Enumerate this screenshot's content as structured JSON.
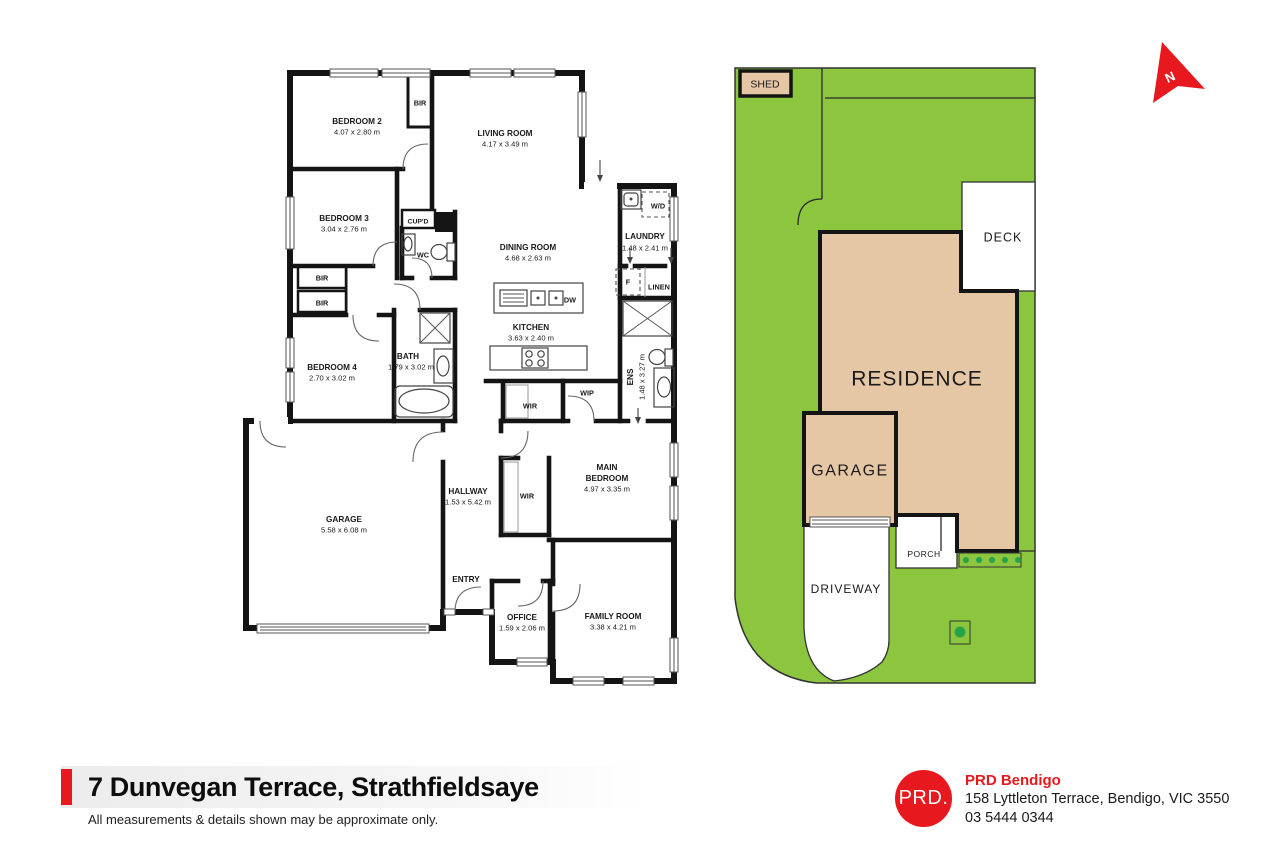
{
  "document_title": "Floor plan flyer",
  "footer": {
    "title": "7 Dunvegan Terrace, Strathfieldsaye",
    "disclaimer": "All measurements & details shown may be approximate only.",
    "brand": {
      "logo": "PRD.",
      "name": "PRD Bendigo",
      "address": "158 Lyttleton Terrace, Bendigo, VIC 3550",
      "phone": "03 5444 0344"
    }
  },
  "colors": {
    "accent_red": "#E8191E",
    "lot_green": "#8CC63F",
    "building_tan": "#E5C6A5",
    "wall_black": "#141414",
    "dot_green": "#29A347",
    "ink": "#1a1a1a"
  },
  "north_indicator": {
    "label": "N"
  },
  "plan_labels": [
    {
      "t": "BEDROOM 2",
      "x": 357,
      "y": 121,
      "s": 8.2,
      "b": 1
    },
    {
      "t": "4.07 x 2.80 m",
      "x": 357,
      "y": 132,
      "s": 7.6
    },
    {
      "t": "BIR",
      "x": 420,
      "y": 103,
      "s": 7.3,
      "b": 1
    },
    {
      "t": "LIVING ROOM",
      "x": 505,
      "y": 133,
      "s": 8.2,
      "b": 1
    },
    {
      "t": "4.17 x 3.49 m",
      "x": 505,
      "y": 144,
      "s": 7.6
    },
    {
      "t": "BEDROOM 3",
      "x": 344,
      "y": 218,
      "s": 8.2,
      "b": 1
    },
    {
      "t": "3.04 x 2.76 m",
      "x": 344,
      "y": 229,
      "s": 7.6
    },
    {
      "t": "CUP'D",
      "x": 418,
      "y": 221,
      "s": 6.8,
      "b": 1
    },
    {
      "t": "WC",
      "x": 423,
      "y": 255,
      "s": 7.3,
      "b": 1
    },
    {
      "t": "DINING ROOM",
      "x": 528,
      "y": 247,
      "s": 8.2,
      "b": 1
    },
    {
      "t": "4.68 x 2.63 m",
      "x": 528,
      "y": 258,
      "s": 7.6
    },
    {
      "t": "W/D",
      "x": 658,
      "y": 206,
      "s": 7.3,
      "b": 1
    },
    {
      "t": "LAUNDRY",
      "x": 645,
      "y": 236,
      "s": 8.2,
      "b": 1
    },
    {
      "t": "1.48 x 2.41 m",
      "x": 645,
      "y": 248,
      "s": 7.6
    },
    {
      "t": "F",
      "x": 628,
      "y": 282,
      "s": 7.3,
      "b": 1
    },
    {
      "t": "LINEN",
      "x": 659,
      "y": 287,
      "s": 7.3,
      "b": 1
    },
    {
      "t": "BIR",
      "x": 322,
      "y": 278,
      "s": 7.3,
      "b": 1
    },
    {
      "t": "BIR",
      "x": 322,
      "y": 303,
      "s": 7.3,
      "b": 1
    },
    {
      "t": "DW",
      "x": 570,
      "y": 300,
      "s": 7.3,
      "b": 1
    },
    {
      "t": "KITCHEN",
      "x": 531,
      "y": 327,
      "s": 8.2,
      "b": 1
    },
    {
      "t": "3.63 x 2.40 m",
      "x": 531,
      "y": 338,
      "s": 7.6
    },
    {
      "t": "BEDROOM 4",
      "x": 332,
      "y": 367,
      "s": 8.2,
      "b": 1
    },
    {
      "t": "2.70 x 3.02 m",
      "x": 332,
      "y": 378,
      "s": 7.6
    },
    {
      "t": "BATH",
      "x": 408,
      "y": 356,
      "s": 8.2,
      "b": 1
    },
    {
      "t": "1.79 x 3.02 m",
      "x": 411,
      "y": 367,
      "s": 7.6
    },
    {
      "t": "ENS",
      "x": 630,
      "y": 377,
      "s": 8.2,
      "b": 1,
      "r": -90
    },
    {
      "t": "1.48 x 3.27 m",
      "x": 642,
      "y": 377,
      "s": 7.6,
      "r": -90
    },
    {
      "t": "WIP",
      "x": 587,
      "y": 393,
      "s": 7.3,
      "b": 1
    },
    {
      "t": "WIR",
      "x": 530,
      "y": 406,
      "s": 7.3,
      "b": 1
    },
    {
      "t": "HALLWAY",
      "x": 468,
      "y": 491,
      "s": 8.2,
      "b": 1
    },
    {
      "t": "1.53 x 5.42 m",
      "x": 468,
      "y": 502,
      "s": 7.6
    },
    {
      "t": "WIR",
      "x": 527,
      "y": 496,
      "s": 7.3,
      "b": 1
    },
    {
      "t": "MAIN",
      "x": 607,
      "y": 467,
      "s": 8.2,
      "b": 1
    },
    {
      "t": "BEDROOM",
      "x": 607,
      "y": 478,
      "s": 8.2,
      "b": 1
    },
    {
      "t": "4.97 x 3.35 m",
      "x": 607,
      "y": 489,
      "s": 7.6
    },
    {
      "t": "GARAGE",
      "x": 344,
      "y": 519,
      "s": 8.2,
      "b": 1
    },
    {
      "t": "5.58 x 6.08 m",
      "x": 344,
      "y": 530,
      "s": 7.6
    },
    {
      "t": "ENTRY",
      "x": 466,
      "y": 579,
      "s": 8.2,
      "b": 1
    },
    {
      "t": "OFFICE",
      "x": 522,
      "y": 617,
      "s": 8.2,
      "b": 1
    },
    {
      "t": "1.59 x 2.06 m",
      "x": 522,
      "y": 628,
      "s": 7.6
    },
    {
      "t": "FAMILY ROOM",
      "x": 613,
      "y": 616,
      "s": 8.2,
      "b": 1
    },
    {
      "t": "3.38 x 4.21 m",
      "x": 613,
      "y": 627,
      "s": 7.6
    },
    {
      "t": "SHED",
      "x": 765,
      "y": 84,
      "s": 10.5
    },
    {
      "t": "DECK",
      "x": 1003,
      "y": 237,
      "s": 12.5,
      "ls": 1
    },
    {
      "t": "RESIDENCE",
      "x": 917,
      "y": 378,
      "s": 21,
      "ls": 1
    },
    {
      "t": "GARAGE",
      "x": 850,
      "y": 470,
      "s": 16,
      "ls": 1.5
    },
    {
      "t": "PORCH",
      "x": 924,
      "y": 554,
      "s": 8.5,
      "ls": 0.5
    },
    {
      "t": "DRIVEWAY",
      "x": 846,
      "y": 589,
      "s": 12,
      "ls": 1
    },
    {
      "t": "N",
      "x": 1170,
      "y": 77,
      "s": 13,
      "b": 1,
      "r": -25,
      "c": "#ffffff"
    }
  ]
}
